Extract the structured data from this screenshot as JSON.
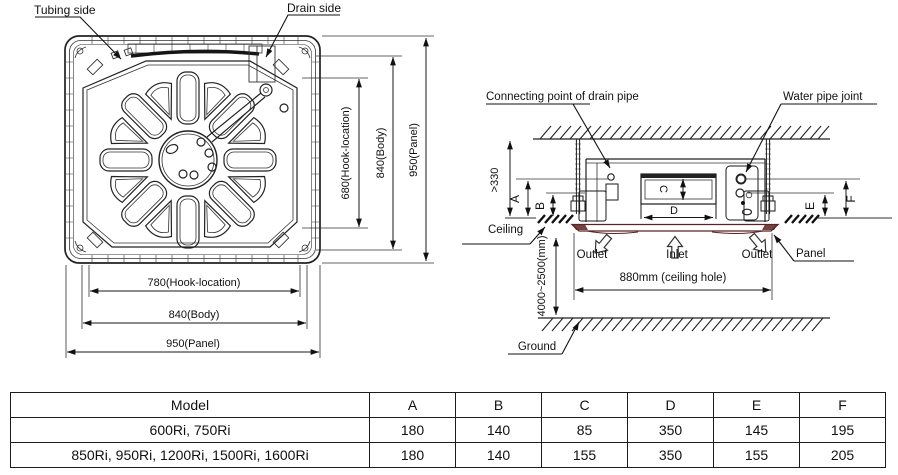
{
  "left_diagram": {
    "labels": {
      "tubing": "Tubing side",
      "drain": "Drain side"
    },
    "vertical_dims": [
      "680(Hook-location)",
      "840(Body)",
      "950(Panel)"
    ],
    "horizontal_dims": [
      "780(Hook-location)",
      "840(Body)",
      "950(Panel)"
    ]
  },
  "right_diagram": {
    "callouts": {
      "drain_pipe": "Connecting point of drain pipe",
      "water_pipe": "Water pipe joint",
      "ceiling": "Ceiling",
      "panel": "Panel",
      "outlet_left": "Outlet",
      "inlet": "Inlet",
      "outlet_right": "Outlet",
      "ground": "Ground"
    },
    "dims": {
      "clearance": ">330",
      "a": "A",
      "b": "B",
      "c": "C",
      "d": "D",
      "e": "E",
      "f": "F",
      "ceiling_hole": "880mm (ceiling hole)",
      "floor_height": "4000~2500(mm)"
    },
    "colors": {
      "panel": "#5a2222"
    }
  },
  "table": {
    "headers": [
      "Model",
      "A",
      "B",
      "C",
      "D",
      "E",
      "F"
    ],
    "rows": [
      [
        "600Ri, 750Ri",
        "180",
        "140",
        "85",
        "350",
        "145",
        "195"
      ],
      [
        "850Ri, 950Ri, 1200Ri, 1500Ri, 1600Ri",
        "180",
        "140",
        "155",
        "350",
        "155",
        "205"
      ]
    ]
  }
}
